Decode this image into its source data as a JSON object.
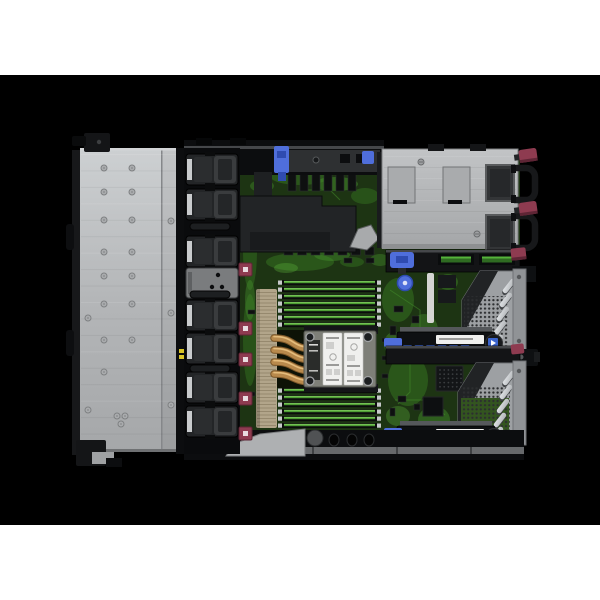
{
  "meta": {
    "image_kind": "product-photo",
    "subject": "top-down-interior-view-of-1u-rack-server-with-cover-removed"
  },
  "palette": {
    "canvas": "#ffffff",
    "photo_bg": "#000000",
    "chassis": "#0c0d0f",
    "wall_face": "#2e3032",
    "wall_hi": "#45474a",
    "silver": "#b7b9bb",
    "silver_hi": "#d2d4d6",
    "silver_lo": "#97999b",
    "edge": "#6f7173",
    "fan_body": "#232527",
    "fan_inner": "#3a3c3e",
    "fan_dark": "#0a0b0d",
    "fan_blank": "#7a7c7e",
    "maroon": "#8e3b50",
    "maroon_dark": "#5e2535",
    "pcb": "#1d3413",
    "pcb_mid": "#2c5a1c",
    "pcb_bright": "#45922c",
    "pcb_glow": "#63bf3f",
    "comp": "#0e1010",
    "fin": "#b2a58a",
    "fin_line": "#8a7d63",
    "copper": "#b8894c",
    "copper_hi": "#e5bc7c",
    "copper_lo": "#7a5527",
    "cpu_frame": "#7e7f78",
    "label_white": "#f0f0ee",
    "label_ink": "#9a9a98",
    "dimm_green": "#4f9e35",
    "dimm_green_hi": "#7cc95b",
    "dimm_black": "#0b0c0c",
    "psu_silver": "#b2b4b6",
    "psu_dark": "#333537",
    "handle": "#17181a",
    "riser_gray": "#9da0a3",
    "riser_rail": "#909396",
    "slat": "#d4d7da",
    "slat_shadow": "#3e4144",
    "dot": "#2c2e30",
    "blue": "#4f6edb",
    "blue_dark": "#2f4bb0",
    "label_blue": "#3b64cc",
    "strip_gray": "#67696b",
    "wedge": "#aeb0b2",
    "yellow": "#d9c428"
  },
  "scene": {
    "photo_band": {
      "top": 75,
      "height": 450
    },
    "front_panel": {
      "brush_lines": 18,
      "screws": [
        [
          104,
          168
        ],
        [
          132,
          168
        ],
        [
          104,
          192
        ],
        [
          132,
          192
        ],
        [
          104,
          220
        ],
        [
          132,
          220
        ],
        [
          104,
          252
        ],
        [
          132,
          252
        ],
        [
          104,
          276
        ],
        [
          132,
          276
        ],
        [
          104,
          304
        ],
        [
          132,
          304
        ],
        [
          104,
          340
        ],
        [
          132,
          340
        ],
        [
          104,
          372
        ],
        [
          171,
          221
        ],
        [
          171,
          313
        ],
        [
          171,
          405
        ],
        [
          88,
          318
        ],
        [
          88,
          410
        ],
        [
          117,
          416
        ],
        [
          125,
          416
        ],
        [
          121,
          424
        ]
      ]
    },
    "fan_bank": {
      "x": 186,
      "w": 52,
      "h": 31,
      "ys": [
        154,
        189,
        236,
        300,
        333,
        372,
        406
      ],
      "blank": {
        "y": 268,
        "h": 30
      },
      "handles": [
        [
          190,
          223
        ],
        [
          190,
          291
        ],
        [
          190,
          365
        ]
      ]
    },
    "fan_connectors": {
      "x": 239,
      "w": 13,
      "h": 13,
      "ys": [
        263,
        322,
        353,
        392,
        427
      ]
    },
    "memory": {
      "x": 282,
      "len": 95,
      "pitch": 7,
      "per_bank": 7,
      "bank_ys": [
        280,
        388
      ]
    },
    "heatpipes": [
      [
        338,
        349
      ],
      [
        350,
        360
      ],
      [
        362,
        371
      ],
      [
        374,
        382
      ]
    ],
    "fin_stack": {
      "x": 256,
      "y": 289,
      "w": 21,
      "h": 139
    },
    "psu": {
      "cutouts": [
        [
          388,
          167
        ],
        [
          443,
          167
        ]
      ],
      "backs": [
        [
          486,
          165
        ],
        [
          486,
          215
        ]
      ],
      "handle_ys": [
        168,
        216
      ],
      "tab_ys": [
        149,
        202
      ],
      "screws": [
        [
          421,
          162
        ],
        [
          477,
          234
        ]
      ],
      "brush_lines": 8
    },
    "risers": [
      {
        "mini_y": 345,
        "slats": [
          [
            509,
            286
          ],
          [
            506,
            300
          ],
          [
            503,
            314
          ],
          [
            500,
            328
          ],
          [
            497,
            342
          ]
        ]
      },
      {
        "mini_y": 439,
        "slats": [
          [
            509,
            378
          ],
          [
            506,
            392
          ],
          [
            503,
            406
          ],
          [
            500,
            420
          ],
          [
            497,
            434
          ]
        ]
      }
    ],
    "mini_labels_per_riser": 6,
    "board": {
      "sockets_row": {
        "x": 288,
        "y": 174,
        "n": 6,
        "dx": 12
      },
      "latch_row": {
        "x": 284,
        "y": 247,
        "n": 7,
        "dx": 13.5
      },
      "blobs": [
        [
          300,
          176,
          30,
          9,
          "pcb_mid",
          0.9
        ],
        [
          336,
          184,
          22,
          7,
          "pcb_bright",
          0.5
        ],
        [
          262,
          186,
          12,
          6,
          "pcb_bright",
          0.4
        ],
        [
          365,
          196,
          14,
          8,
          "pcb_mid",
          0.8
        ],
        [
          300,
          262,
          34,
          9,
          "pcb_mid",
          0.9
        ],
        [
          332,
          255,
          18,
          6,
          "pcb_bright",
          0.45
        ],
        [
          286,
          268,
          12,
          5,
          "pcb_glow",
          0.3
        ],
        [
          250,
          250,
          7,
          40,
          "pcb_mid",
          0.8
        ],
        [
          250,
          340,
          7,
          46,
          "pcb_mid",
          0.8
        ],
        [
          250,
          300,
          5,
          20,
          "pcb_bright",
          0.4
        ],
        [
          398,
          300,
          16,
          22,
          "pcb_mid",
          0.9
        ],
        [
          424,
          330,
          14,
          16,
          "pcb_bright",
          0.4
        ],
        [
          394,
          344,
          10,
          12,
          "pcb_glow",
          0.3
        ],
        [
          408,
          380,
          20,
          26,
          "pcb_mid",
          0.9
        ],
        [
          434,
          420,
          16,
          14,
          "pcb_bright",
          0.45
        ],
        [
          398,
          416,
          12,
          10,
          "pcb_glow",
          0.3
        ],
        [
          448,
          282,
          10,
          8,
          "pcb_bright",
          0.4
        ],
        [
          300,
          352,
          14,
          10,
          "pcb_mid",
          0.9
        ],
        [
          296,
          368,
          10,
          8,
          "pcb_bright",
          0.35
        ],
        [
          380,
          260,
          10,
          6,
          "pcb_bright",
          0.4
        ],
        [
          352,
          262,
          12,
          5,
          "pcb_mid",
          0.8
        ]
      ],
      "traces": [
        "M250,200 L250,240",
        "M390,290 L420,310 L420,340",
        "M395,400 L430,400 L445,415",
        "M300,190 L330,190 L340,200",
        "M410,360 L410,392 L398,404"
      ],
      "components": [
        [
          382,
          338,
          6,
          4
        ],
        [
          382,
          356,
          6,
          4
        ],
        [
          382,
          374,
          6,
          4
        ],
        [
          394,
          306,
          9,
          6
        ],
        [
          412,
          316,
          7,
          7
        ],
        [
          390,
          326,
          6,
          9
        ],
        [
          428,
          346,
          8,
          5
        ],
        [
          398,
          396,
          8,
          6
        ],
        [
          414,
          404,
          6,
          6
        ],
        [
          390,
          408,
          5,
          8
        ],
        [
          444,
          430,
          8,
          5
        ],
        [
          300,
          168,
          8,
          4
        ],
        [
          326,
          168,
          8,
          4
        ],
        [
          350,
          170,
          7,
          4
        ],
        [
          248,
          208,
          7,
          4
        ],
        [
          248,
          310,
          7,
          4
        ],
        [
          248,
          392,
          7,
          4
        ],
        [
          366,
          258,
          8,
          5
        ],
        [
          344,
          258,
          8,
          5
        ]
      ]
    },
    "chip_grid": {
      "x": 437,
      "y": 367,
      "cols": 6,
      "rows": 5,
      "dx": 4.2
    }
  }
}
